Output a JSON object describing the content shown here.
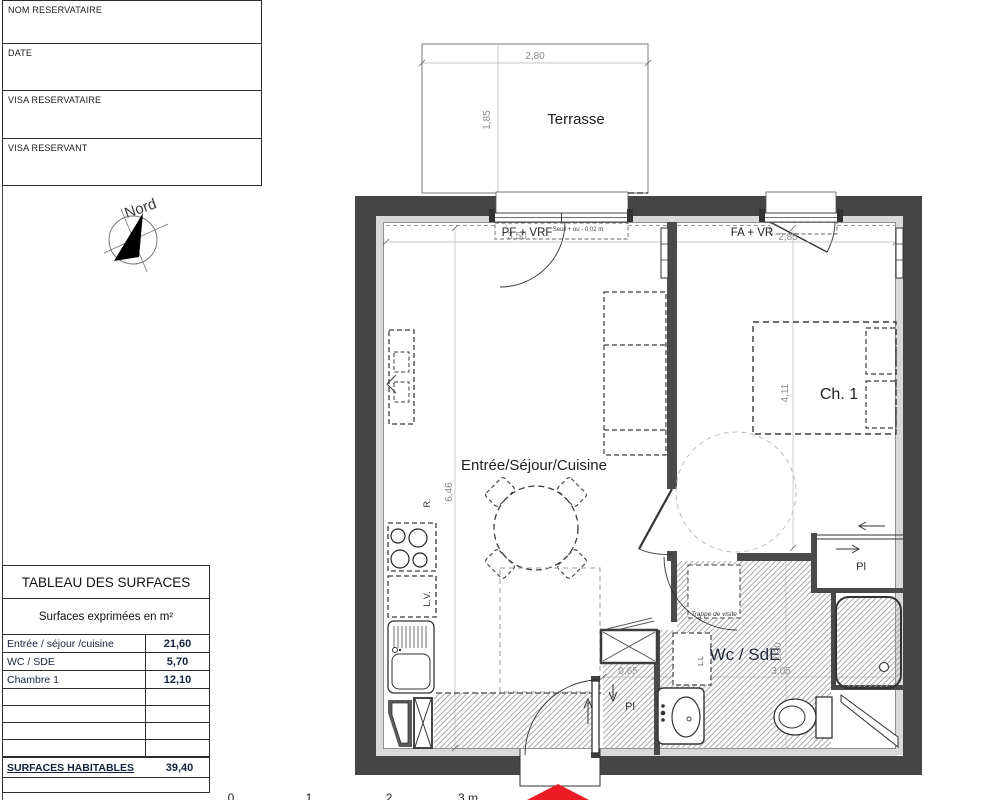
{
  "signature_table": {
    "rows": [
      "NOM RESERVATAIRE",
      "DATE",
      "VISA RESERVATAIRE",
      "VISA RESERVANT"
    ]
  },
  "compass": {
    "label": "Nord"
  },
  "surfaces_table": {
    "title": "TABLEAU DES SURFACES",
    "subtitle": "Surfaces exprimées en m²",
    "rows": [
      {
        "label": "Entrée / séjour /cuisine",
        "value": "21,60"
      },
      {
        "label": "WC / SDE",
        "value": "5,70"
      },
      {
        "label": "Chambre 1",
        "value": "12,10"
      }
    ],
    "total": {
      "label": "SURFACES HABITABLES",
      "value": "39,40"
    }
  },
  "plan": {
    "rooms": {
      "terrace": "Terrasse",
      "living": "Entrée/Séjour/Cuisine",
      "bedroom": "Ch. 1",
      "bathroom": "Wc / SdE"
    },
    "openings": {
      "living_window": "PF + VRF",
      "living_window_threshold": "Seuil + ou - 0,02 m",
      "bedroom_window": "FA + VR"
    },
    "fixtures": {
      "bedroom_closet": "Pl",
      "entry_closet": "Pl",
      "fridge": "R.",
      "dishwasher": "L.V.",
      "washing_machine": "L.L",
      "access_hatch": "Trappe de visite"
    },
    "dimensions": {
      "terrace_width": "2,80",
      "terrace_depth": "1,85",
      "living_width": "3,50",
      "bedroom_width": "2,85",
      "living_length": "6,46",
      "bedroom_length": "4,11",
      "bathroom_width": "3,05",
      "bathroom_depth": "2,30",
      "entry_closet_width": "0,65"
    },
    "scale_ticks": [
      "0",
      "1",
      "2",
      "3 m"
    ]
  },
  "colors": {
    "wall": "#454545",
    "accent_red": "#ec1b24",
    "hatch": "#9c9c9c"
  }
}
